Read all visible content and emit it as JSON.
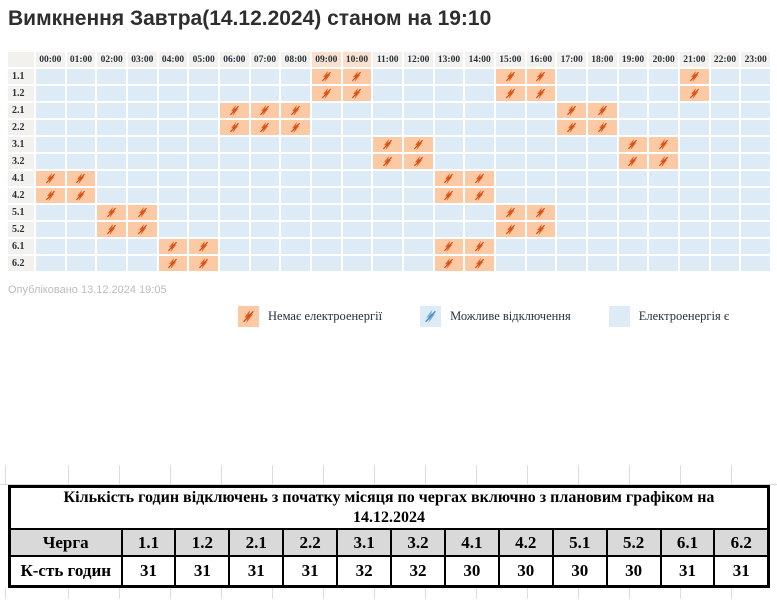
{
  "title": "Вимкнення Завтра(14.12.2024) станом на 19:10",
  "published": "Опубліковано 13.12.2024 19:05",
  "colors": {
    "outage_cell": "#fbc9a4",
    "available_cell": "#dcebf5",
    "grid_header_bg": "#f2f1ee",
    "header_highlight": "#fae0cd",
    "outage_icon": "#e8611f",
    "outage_slash": "#c94b18",
    "possible_icon": "#79afdb",
    "possible_slash": "#4a86c0",
    "table_header_row_bg": "#d9d9d9"
  },
  "chart_data": [
    {
      "type": "heatmap",
      "title": "Вимкнення Завтра(14.12.2024) станом на 19:10",
      "x_ticks": [
        "00:00",
        "01:00",
        "02:00",
        "03:00",
        "04:00",
        "05:00",
        "06:00",
        "07:00",
        "08:00",
        "09:00",
        "10:00",
        "11:00",
        "12:00",
        "13:00",
        "14:00",
        "15:00",
        "16:00",
        "17:00",
        "18:00",
        "19:00",
        "20:00",
        "21:00",
        "22:00",
        "23:00"
      ],
      "highlighted_x_ticks": [
        "09:00",
        "10:00"
      ],
      "row_labels": [
        "1.1",
        "1.2",
        "2.1",
        "2.2",
        "3.1",
        "3.2",
        "4.1",
        "4.2",
        "5.1",
        "5.2",
        "6.1",
        "6.2"
      ],
      "outage_hours_by_row": {
        "1.1": [
          9,
          10,
          15,
          16,
          21
        ],
        "1.2": [
          9,
          10,
          15,
          16,
          21
        ],
        "2.1": [
          6,
          7,
          8,
          17,
          18
        ],
        "2.2": [
          6,
          7,
          8,
          17,
          18
        ],
        "3.1": [
          11,
          12,
          19,
          20
        ],
        "3.2": [
          11,
          12,
          19,
          20
        ],
        "4.1": [
          0,
          1,
          13,
          14
        ],
        "4.2": [
          0,
          1,
          13,
          14
        ],
        "5.1": [
          2,
          3,
          15,
          16
        ],
        "5.2": [
          2,
          3,
          15,
          16
        ],
        "6.1": [
          4,
          5,
          13,
          14
        ],
        "6.2": [
          4,
          5,
          13,
          14
        ]
      },
      "legend": [
        {
          "label": "Немає електроенергії",
          "state": "outage"
        },
        {
          "label": "Можливе відключення",
          "state": "possible"
        },
        {
          "label": "Електроенергія є",
          "state": "available"
        }
      ]
    },
    {
      "type": "table",
      "title_lines": [
        "Кількість годин відключень з початку місяця по чергах включно з плановим графіком на",
        "14.12.2024"
      ],
      "row1_label": "Черга",
      "row1_values": [
        "1.1",
        "1.2",
        "2.1",
        "2.2",
        "3.1",
        "3.2",
        "4.1",
        "4.2",
        "5.1",
        "5.2",
        "6.1",
        "6.2"
      ],
      "row2_label": "К-сть годин",
      "row2_values": [
        "31",
        "31",
        "31",
        "31",
        "32",
        "32",
        "30",
        "30",
        "30",
        "30",
        "31",
        "31"
      ]
    }
  ]
}
